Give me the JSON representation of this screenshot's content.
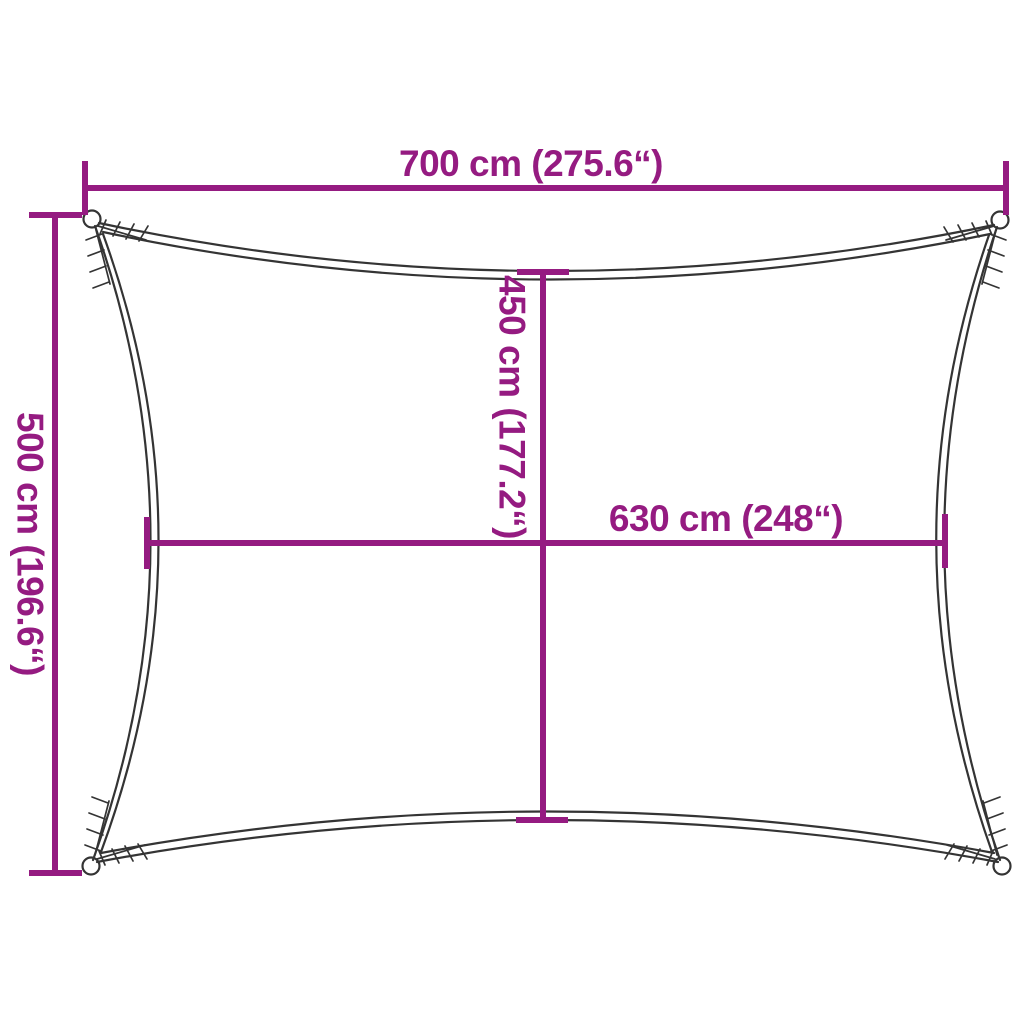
{
  "diagram": {
    "type": "product-dimension-diagram",
    "subject": "rectangular shade sail with concave edges and corner eyelets",
    "dimensions": {
      "top_width": {
        "label": "700 cm (275.6“)",
        "value_cm": 700,
        "value_inch": 275.6
      },
      "left_height": {
        "label": "500 cm (196.6“)",
        "value_cm": 500,
        "value_inch": 196.6
      },
      "inner_height": {
        "label": "450 cm (177.2“)",
        "value_cm": 450,
        "value_inch": 177.2
      },
      "inner_width": {
        "label": "630 cm (248“)",
        "value_cm": 630,
        "value_inch": 248
      }
    },
    "colors": {
      "dimension": "#951b81",
      "outline": "#343434",
      "background": "#ffffff"
    }
  }
}
